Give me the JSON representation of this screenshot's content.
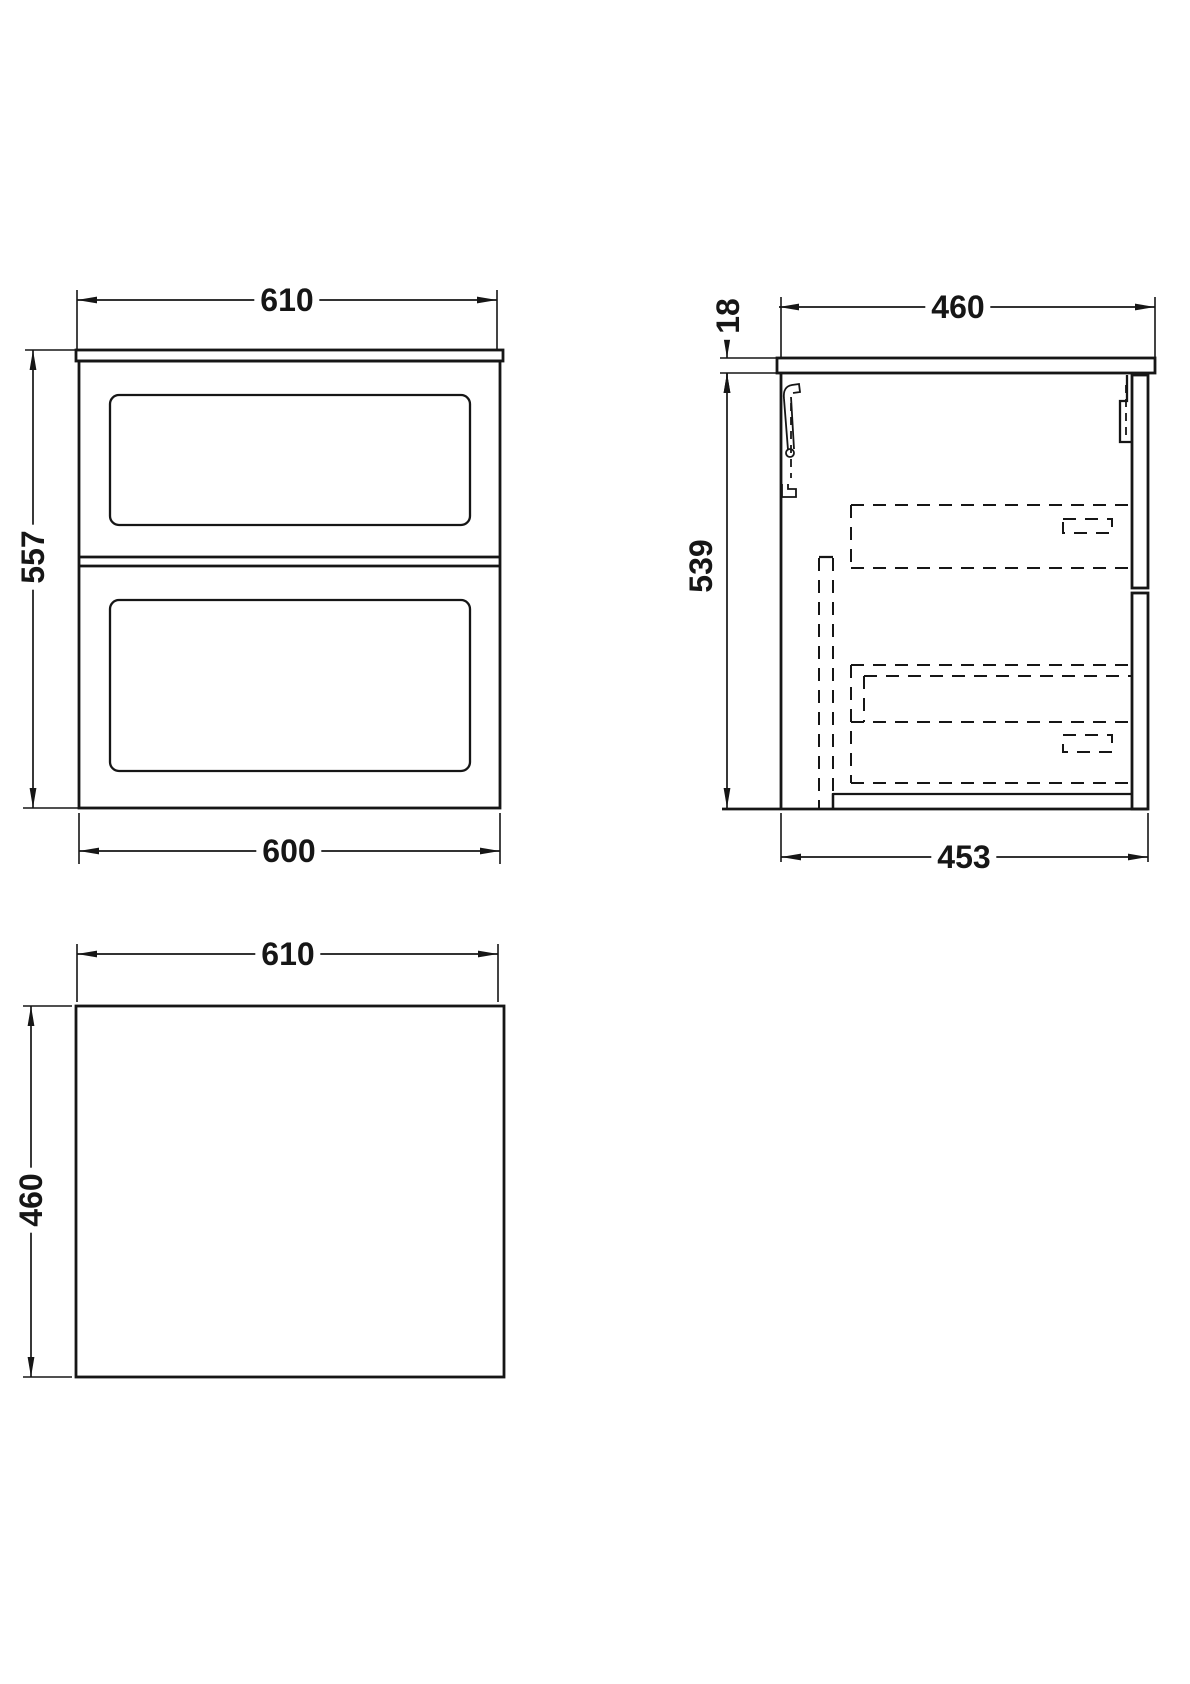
{
  "colors": {
    "background": "#ffffff",
    "line": "#161616"
  },
  "views": {
    "front": {
      "top_width": "610",
      "height": "557",
      "bottom_width": "600"
    },
    "side": {
      "top_depth": "460",
      "worktop_thickness": "18",
      "carcass_height": "539",
      "carcass_depth": "453"
    },
    "plan": {
      "width": "610",
      "depth": "460"
    }
  }
}
